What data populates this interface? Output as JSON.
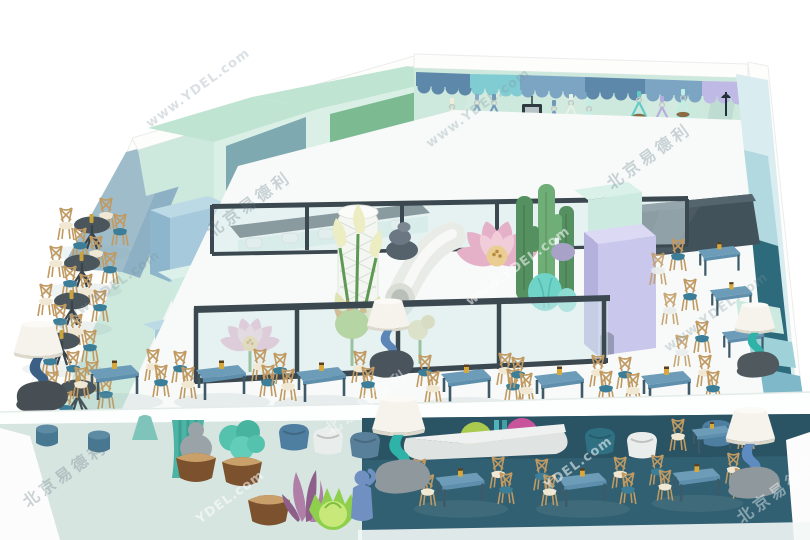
{
  "meta": {
    "title": "3D interior render — two-level ocean/cloud themed indoor playground cafe",
    "width_px": 810,
    "height_px": 540
  },
  "watermark": {
    "url": "www.YDEL.com",
    "url_short": "YDEL.com",
    "brand": "北京易德利"
  },
  "palette": {
    "bg": "#ffffff",
    "wall-mint": "#cde8dc",
    "wall-mint-deep": "#a9d6c3",
    "wall-bluegray": "#9fbccb",
    "cabinet-top": "#bfe5d2",
    "cabinet-face": "#daf0e6",
    "cabinet-int-blue": "#7fa9b0",
    "cabinet-int-green": "#7cba92",
    "cube-blue": "#a6c9db",
    "cube-blue-side": "#8db6cc",
    "cube-mint": "#cdeae1",
    "cube-lavender": "#c9c7ec",
    "frame-dark": "#3b484f",
    "glass": "#d5e9eb",
    "floor-white": "#f7faf9",
    "lower-left-floor": "#d7e5e1",
    "lower-right-floor": "#316072",
    "table-blue": "#5e90ae",
    "table-top": "#6d9cb8",
    "table-leg": "#3e5a68",
    "wood": "#c19a62",
    "seat-cream": "#f0e8d2",
    "seat-teal": "#3c7e98",
    "round-top": "#4a555c",
    "rail-blue": "#4a80a9",
    "bench-teal": "#2d6a7c",
    "board": "#42525a",
    "cloud-navy": "#5d88a9",
    "cloud-blue": "#7ca4c3",
    "cloud-teal": "#80ccd2",
    "cloud-lavender": "#beb9e5",
    "cactus": "#559160",
    "cactus-teal": "#6fd3c8",
    "lotus-pink": "#e5b1c8",
    "lotus-yellow": "#eacd92",
    "calla": "#ededc4",
    "lamp-shade": "#f5f3ec",
    "lamp-navy": "#3c5f86",
    "lamp-teal": "#2fb3a9",
    "lamp-blue": "#5f8cc0",
    "rock": "#8e989d"
  },
  "scene": {
    "theme": "ocean / cloud kids-play restaurant, axonometric cutaway, two levels",
    "upper_level": {
      "hanging_pod_swings": 9,
      "wall_cloud_trim": true,
      "round_tables_left_wall": 5,
      "square_dining_tables": 6,
      "side_tables_right_wall": 3,
      "glass_fenced_play_area": [
        "spiral tower",
        "tube slide",
        "giant calla lilies",
        "giant lotus flowers",
        "cacti",
        "pebble stacks",
        "mint cube",
        "lavender cube"
      ],
      "bar_counter_stools": 5,
      "floor_lamps": 4,
      "stair_railing_right": true,
      "leaning_dark_board": true
    },
    "lower_level": {
      "dining_tables": 4,
      "tub_armchairs": 6,
      "floor_lamps": 2,
      "planters": [
        "teal shrub basket",
        "empty basket",
        "purple plant",
        "green cabbage sculpture",
        "blue figure statue",
        "gray figure in basket"
      ],
      "decor_balls": [
        "green",
        "magenta"
      ],
      "cylinder_stools": 3
    }
  }
}
